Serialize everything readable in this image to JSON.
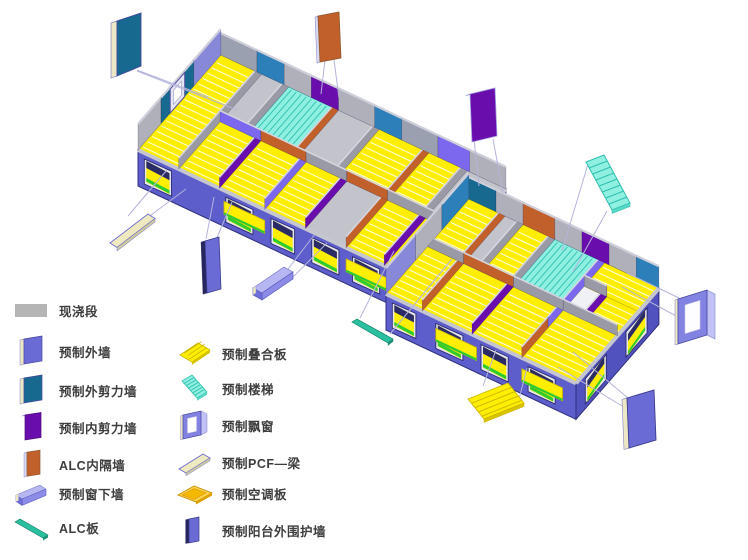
{
  "diagram": {
    "type": "exploded-axonometric-building-floor",
    "modules": 2,
    "callouts": [
      {
        "component": "预制外剪力墙",
        "position": "top-left"
      },
      {
        "component": "ALC内隔墙",
        "position": "top-center"
      },
      {
        "component": "预制内剪力墙",
        "position": "top-right-of-center"
      },
      {
        "component": "预制楼梯",
        "position": "upper-right"
      },
      {
        "component": "预制飘窗",
        "position": "right"
      },
      {
        "component": "预制外墙",
        "position": "bottom-right"
      },
      {
        "component": "预制叠合板",
        "position": "bottom-center-right"
      },
      {
        "component": "ALC板",
        "position": "bottom-center"
      },
      {
        "component": "预制窗下墙",
        "position": "bottom-center-left"
      },
      {
        "component": "预制阳台外围护墙",
        "position": "bottom-left-of-center"
      },
      {
        "component": "预制PCF—梁",
        "position": "bottom-left"
      }
    ]
  },
  "legend": {
    "columns": [
      {
        "items": [
          {
            "icon": "cast-in-place",
            "label": "现浇段",
            "color": "#b5b5b5"
          },
          {
            "icon": "precast-exterior-wall",
            "label": "预制外墙",
            "color": "#6b6bd6"
          },
          {
            "icon": "precast-exterior-shear-wall",
            "label": "预制外剪力墙",
            "color": "#17698f"
          },
          {
            "icon": "precast-interior-shear-wall",
            "label": "预制内剪力墙",
            "color": "#6a0dad"
          },
          {
            "icon": "alc-interior-partition-wall",
            "label": "ALC内隔墙",
            "color": "#c2602c"
          },
          {
            "icon": "precast-window-sill-wall",
            "label": "预制窗下墙",
            "color": "#8c8ce8"
          },
          {
            "icon": "alc-panel",
            "label": "ALC板",
            "color": "#2abf9e"
          }
        ]
      },
      {
        "items": [
          {
            "icon": "precast-composite-slab",
            "label": "预制叠合板",
            "color": "#ffee00"
          },
          {
            "icon": "precast-stair",
            "label": "预制楼梯",
            "color": "#8ff0e2"
          },
          {
            "icon": "precast-bay-window",
            "label": "预制飘窗",
            "color": "#8282e2"
          },
          {
            "icon": "precast-pcf-beam",
            "label": "预制PCF—梁",
            "color": "#efe9c0"
          },
          {
            "icon": "precast-ac-slab",
            "label": "预制空调板",
            "color": "#f5b800"
          },
          {
            "icon": "precast-balcony-enclosure-wall",
            "label": "预制阳台外围护墙",
            "color": "#6b6bd6"
          }
        ]
      }
    ]
  },
  "palette": {
    "slab_yellow": "#ffee00",
    "wall_exterior_blue": "#5d5dcc",
    "wall_exterior_side": "#5252be",
    "cast_gray": "#b5b5b5",
    "floor_gray": "#c9c9d2",
    "stair_cyan": "#8ff0e2",
    "shear_exterior_teal": "#17698f",
    "shear_interior_purple": "#6a0dad",
    "alc_orange": "#c2602c",
    "sill_lavender": "#8c8ce8",
    "alc_green": "#2abf9e",
    "pcf_cream": "#efe9c0",
    "ac_amber": "#f5b800",
    "back_wall_blue": "#2c7fb8",
    "window_green": "#2ecc2e",
    "leader_line": "#b4b4dc",
    "text": "#3d3d3d"
  }
}
